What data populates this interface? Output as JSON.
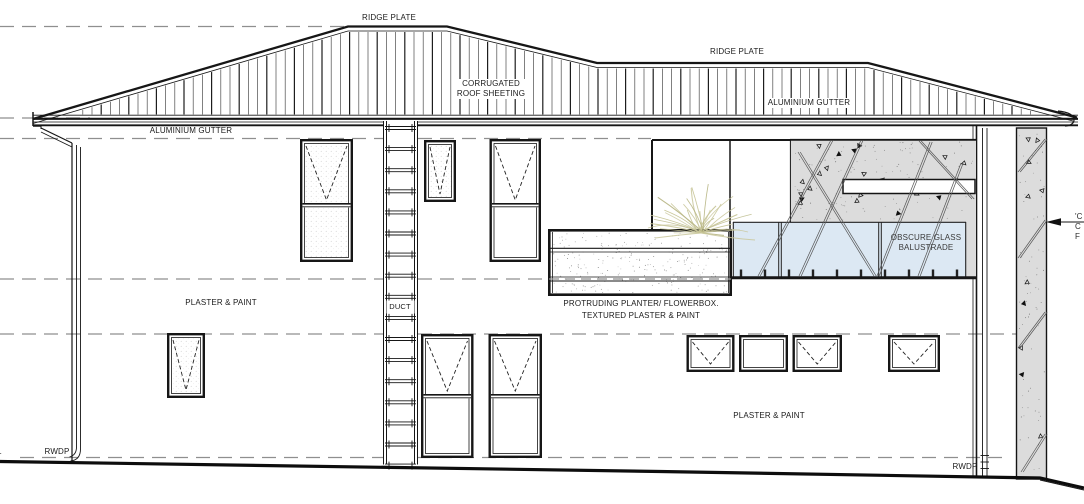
{
  "annotations": {
    "ridge_plate_left": "RIDGE PLATE",
    "ridge_plate_right": "RIDGE PLATE",
    "corrugated_roof_line1": "CORRUGATED",
    "corrugated_roof_line2": "ROOF SHEETING",
    "aluminium_gutter_left": "ALUMINIUM GUTTER",
    "aluminium_gutter_right": "ALUMINIUM GUTTER",
    "plaster_paint_upper": "PLASTER & PAINT",
    "plaster_paint_lower": "PLASTER & PAINT",
    "duct": "DUCT",
    "planter_line1": "PROTRUDING PLANTER/ FLOWERBOX.",
    "planter_line2": "TEXTURED PLASTER & PAINT",
    "balustrade_line1": "OBSCURE GLASS",
    "balustrade_line2": "BALUSTRADE",
    "rwdp_left": "RWDP",
    "rwdp_right": "RWDP",
    "left_edge_fragment": "L",
    "right_edge_fragment_line1": "'C",
    "right_edge_fragment_line2": "C",
    "right_edge_fragment_line3": "F"
  },
  "colors": {
    "line": "#161616",
    "dashed_level_line": "#8f8f8f",
    "stone_fill": "#dcdcdc",
    "glass_fill": "#dce8f3",
    "plant_stroke": "#c9c79b",
    "plant_stroke_dark": "#b7b582",
    "background": "#ffffff"
  }
}
